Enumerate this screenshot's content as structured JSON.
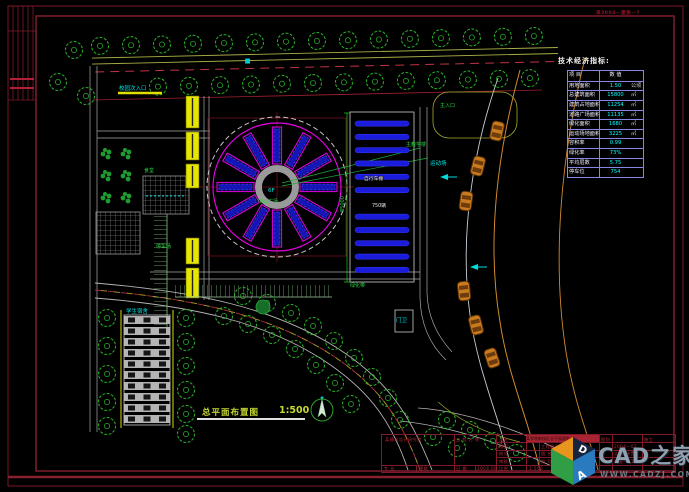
{
  "frame": {
    "stamp": "津2004—建施—7"
  },
  "caption": {
    "title": "总平面布置图",
    "scale": "1:500"
  },
  "econ_table": {
    "title": "技术经济指标:",
    "rows": [
      {
        "label": "项 目",
        "value": "数 值",
        "unit": ""
      },
      {
        "label": "用地面积",
        "value": "1.50",
        "unit": "公顷"
      },
      {
        "label": "总建筑面积",
        "value": "15800",
        "unit": "㎡"
      },
      {
        "label": "建筑占地面积",
        "value": "11254",
        "unit": "㎡"
      },
      {
        "label": "道路广场面积",
        "value": "11135",
        "unit": "㎡"
      },
      {
        "label": "绿化面积",
        "value": "1680",
        "unit": "㎡"
      },
      {
        "label": "运动场地面积",
        "value": "3225",
        "unit": "㎡"
      },
      {
        "label": "容积率",
        "value": "0.99",
        "unit": ""
      },
      {
        "label": "绿化率",
        "value": "73%",
        "unit": ""
      },
      {
        "label": "平均层数",
        "value": "5.75",
        "unit": ""
      },
      {
        "label": "停车位",
        "value": "754",
        "unit": ""
      }
    ]
  },
  "titleblock": {
    "org": "某建筑设计研究院",
    "owner_label": "工 程 名 称",
    "major_label": "专 业",
    "major": "建筑",
    "date_label": "日 期",
    "date": "2004.06",
    "row_design": "设计",
    "row_draft": "制图",
    "row_check": "校对",
    "row_review": "审核",
    "row_scale_label": "比例",
    "scale": "1:500",
    "project": "某学院新校区总平面规划",
    "sheet_type_label": "图别",
    "sheet_type": "施工",
    "proj_no_label": "工程编号",
    "proj_no": "2004—07",
    "name_label": "图 名",
    "name": "总平面布置图",
    "no_label": "图 号",
    "no": "建施—01"
  },
  "logo": {
    "site": "CAD之家",
    "url": "WWW.CADZJ.COM",
    "cube_letter_a": "A",
    "cube_letter_d": "D"
  },
  "annotations": [
    {
      "text": "校园次入口"
    },
    {
      "text": "主入口"
    },
    {
      "text": "6F"
    },
    {
      "text": "中心广场"
    },
    {
      "text": "主教学楼"
    },
    {
      "text": "自行车棚"
    },
    {
      "text": "750辆"
    },
    {
      "text": "停车场"
    },
    {
      "text": "学生宿舍"
    },
    {
      "text": "门卫"
    },
    {
      "text": "绿化带"
    },
    {
      "text": "85000"
    },
    {
      "text": "食堂"
    },
    {
      "text": "运动场"
    }
  ],
  "colors": {
    "background": "#000000",
    "frame_red": "#8a1d2c",
    "tree_green": "#28b428",
    "accent_magenta": "#e400e4",
    "accent_blue": "#2222e0",
    "text_cyan": "#00e6e6",
    "car_orange": "#c87a1e",
    "highlight_yellow": "#e6e600",
    "table_grid": "#8686e6"
  }
}
